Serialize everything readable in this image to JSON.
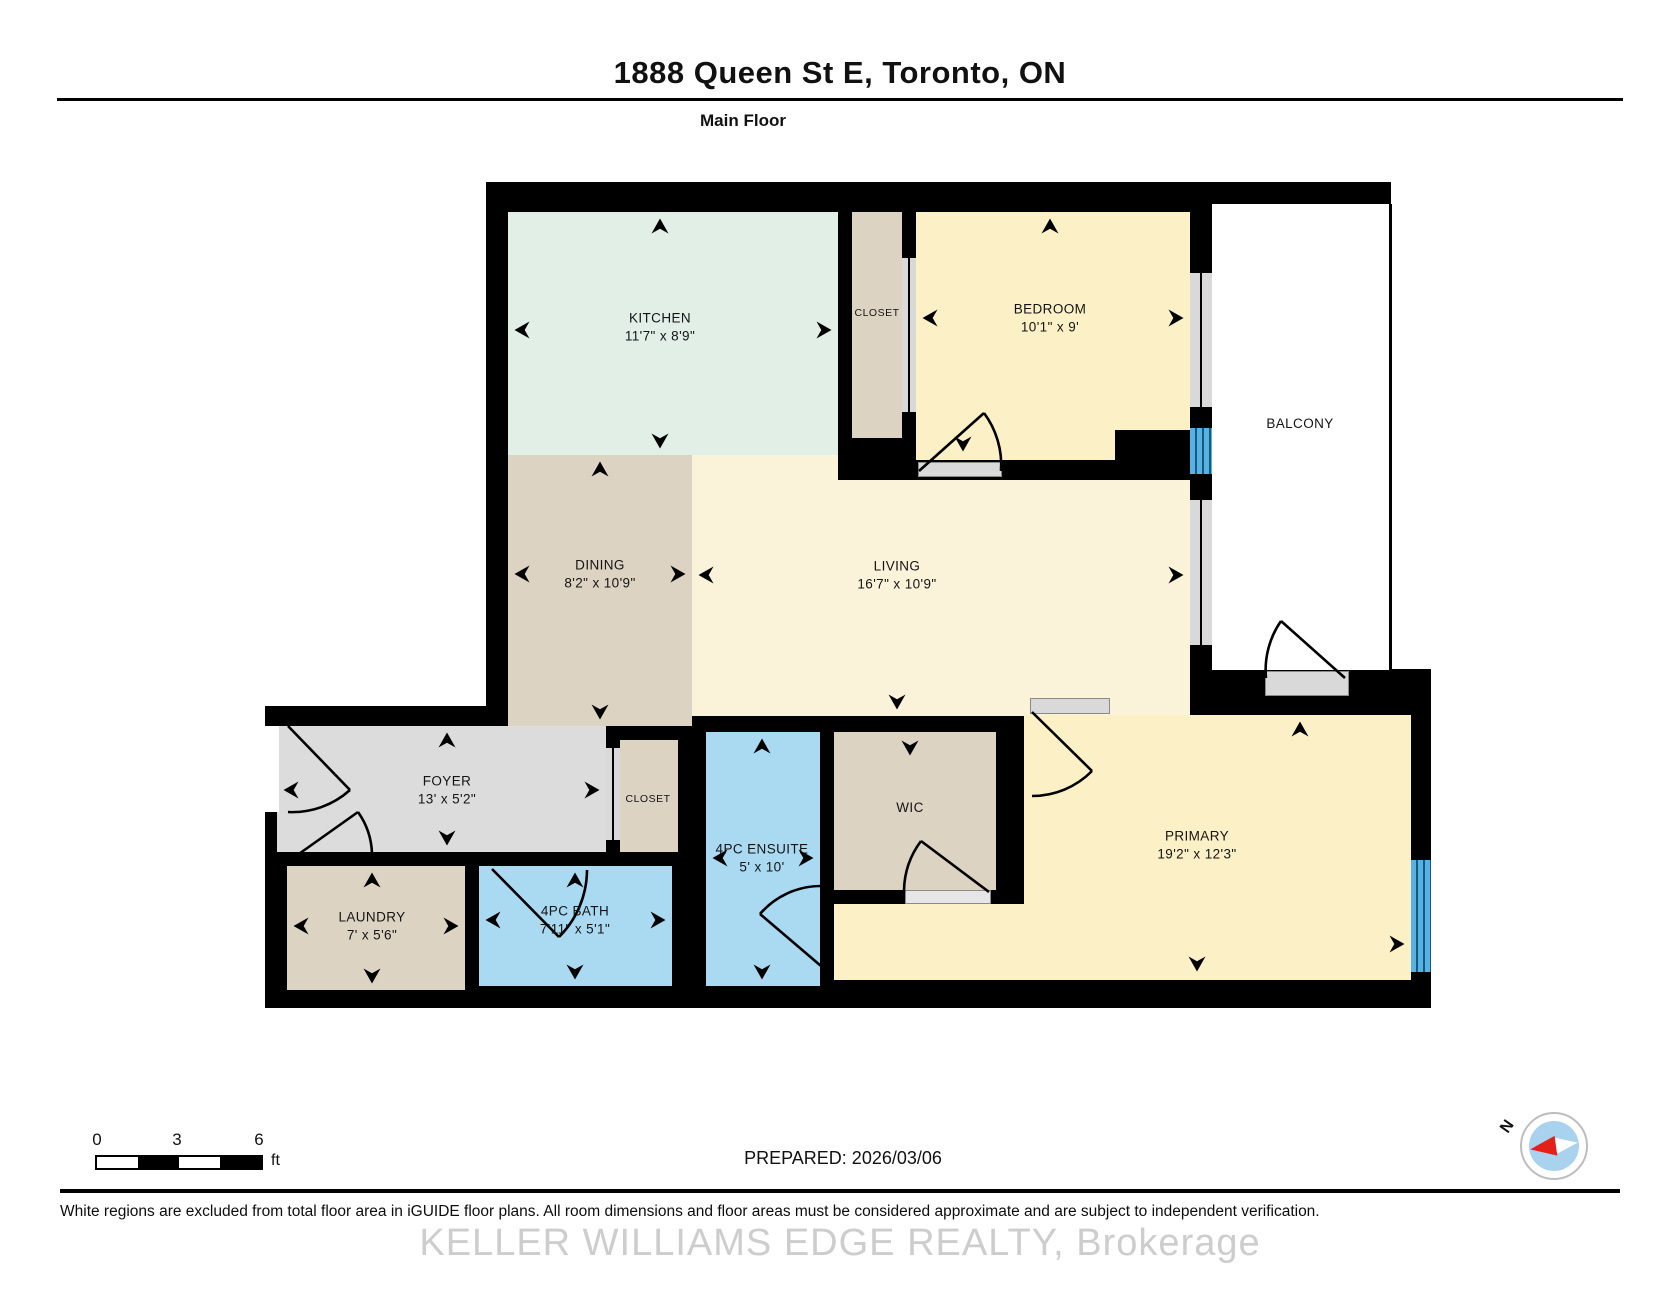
{
  "header": {
    "title": "1888 Queen St E, Toronto, ON",
    "floor_label": "Main Floor"
  },
  "rooms": {
    "kitchen": {
      "name": "KITCHEN",
      "dims": "11'7\" x 8'9\""
    },
    "closet_top": {
      "name": "CLOSET"
    },
    "bedroom": {
      "name": "BEDROOM",
      "dims": "10'1\" x 9'"
    },
    "balcony": {
      "name": "BALCONY"
    },
    "dining": {
      "name": "DINING",
      "dims": "8'2\" x 10'9\""
    },
    "living": {
      "name": "LIVING",
      "dims": "16'7\" x 10'9\""
    },
    "foyer": {
      "name": "FOYER",
      "dims": "13' x 5'2\""
    },
    "closet_foyer": {
      "name": "CLOSET"
    },
    "ensuite": {
      "name": "4PC ENSUITE",
      "dims": "5' x 10'"
    },
    "wic": {
      "name": "WIC"
    },
    "primary": {
      "name": "PRIMARY",
      "dims": "19'2\" x 12'3\""
    },
    "laundry": {
      "name": "LAUNDRY",
      "dims": "7' x 5'6\""
    },
    "bath": {
      "name": "4PC BATH",
      "dims": "7'11\" x 5'1\""
    }
  },
  "scale": {
    "ticks": [
      "0",
      "3",
      "6"
    ],
    "unit": "ft"
  },
  "compass": {
    "north_label": "N"
  },
  "footer": {
    "prepared": "PREPARED: 2026/03/06",
    "disclaimer": "White regions are excluded from total floor area in iGUIDE floor plans. All room dimensions and floor areas must be considered approximate and are subject to independent verification.",
    "watermark": "KELLER WILLIAMS EDGE REALTY, Brokerage"
  },
  "colors": {
    "wall": "#000000",
    "kitchen": "#e2efe7",
    "bedroom_primary": "#fbf0c6",
    "living": "#faf3da",
    "dining_closets": "#ddd3c2",
    "foyer": "#dcdcdc",
    "bath_blue": "#a9daf2",
    "window_gray": "#d9d9d9",
    "window_blue": "#57b1e3",
    "compass_red": "#e32119",
    "compass_blue": "#a9d2ee"
  }
}
